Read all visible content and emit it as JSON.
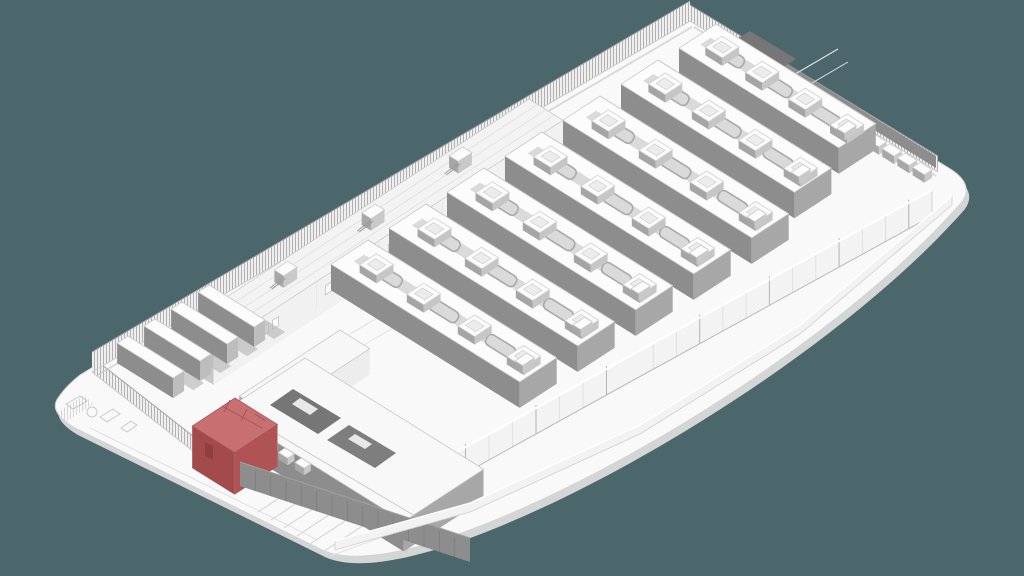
{
  "scene": {
    "type": "isometric-architectural-diagram",
    "subject": "data-center-campus-site-model",
    "has_text": false,
    "view": "axonometric-from-southwest",
    "highlight_state": "one-building-selected-red"
  },
  "palette": {
    "background": "#4b676c",
    "plate": "#f9f9f9",
    "plate_edge": "#d4d6d6",
    "outline_light": "#d3d3d3",
    "outline_mid": "#bdbdbd",
    "outline_dark": "#9a9a9a",
    "roof_white": "#fcfcfc",
    "wall_white": "#f3f3f3",
    "gray_light": "#c9c9c9",
    "gray_mid": "#a7a7a7",
    "gray_dark": "#8d8d8d",
    "gray_darker": "#767676",
    "shadow": "#b7b7b7",
    "fence_bg": "#efefef",
    "fence_line": "#a3a3a3",
    "road_line": "#e2e2e2",
    "highlight_roof": "#c87071",
    "highlight_wall_left": "#a34a4c",
    "highlight_wall_right": "#b05354",
    "highlight_line": "#a85456",
    "highlight_door": "#8e3f41"
  },
  "elements": {
    "hall_rows": {
      "count": 7,
      "rooftop_units_per_row": 4,
      "pipe_loops_per_row": 3
    },
    "generator_yard": {
      "container_count": 4
    },
    "chiller_row": {
      "unit_count": 12
    },
    "spine_building": {
      "window_pairs": 5,
      "rooftop_plant_count": 4
    },
    "front_complex": {
      "roof_vent_count": 4,
      "dark_courtyards": 2
    },
    "perimeter": {
      "fence_sides": [
        "back",
        "left",
        "right"
      ],
      "wall_sides": [
        "front"
      ]
    },
    "apron_markings": {
      "parking_stripes": 6,
      "pads": 3
    },
    "highlighted_building": {
      "id": "highlighted-building",
      "state": "selected"
    }
  }
}
